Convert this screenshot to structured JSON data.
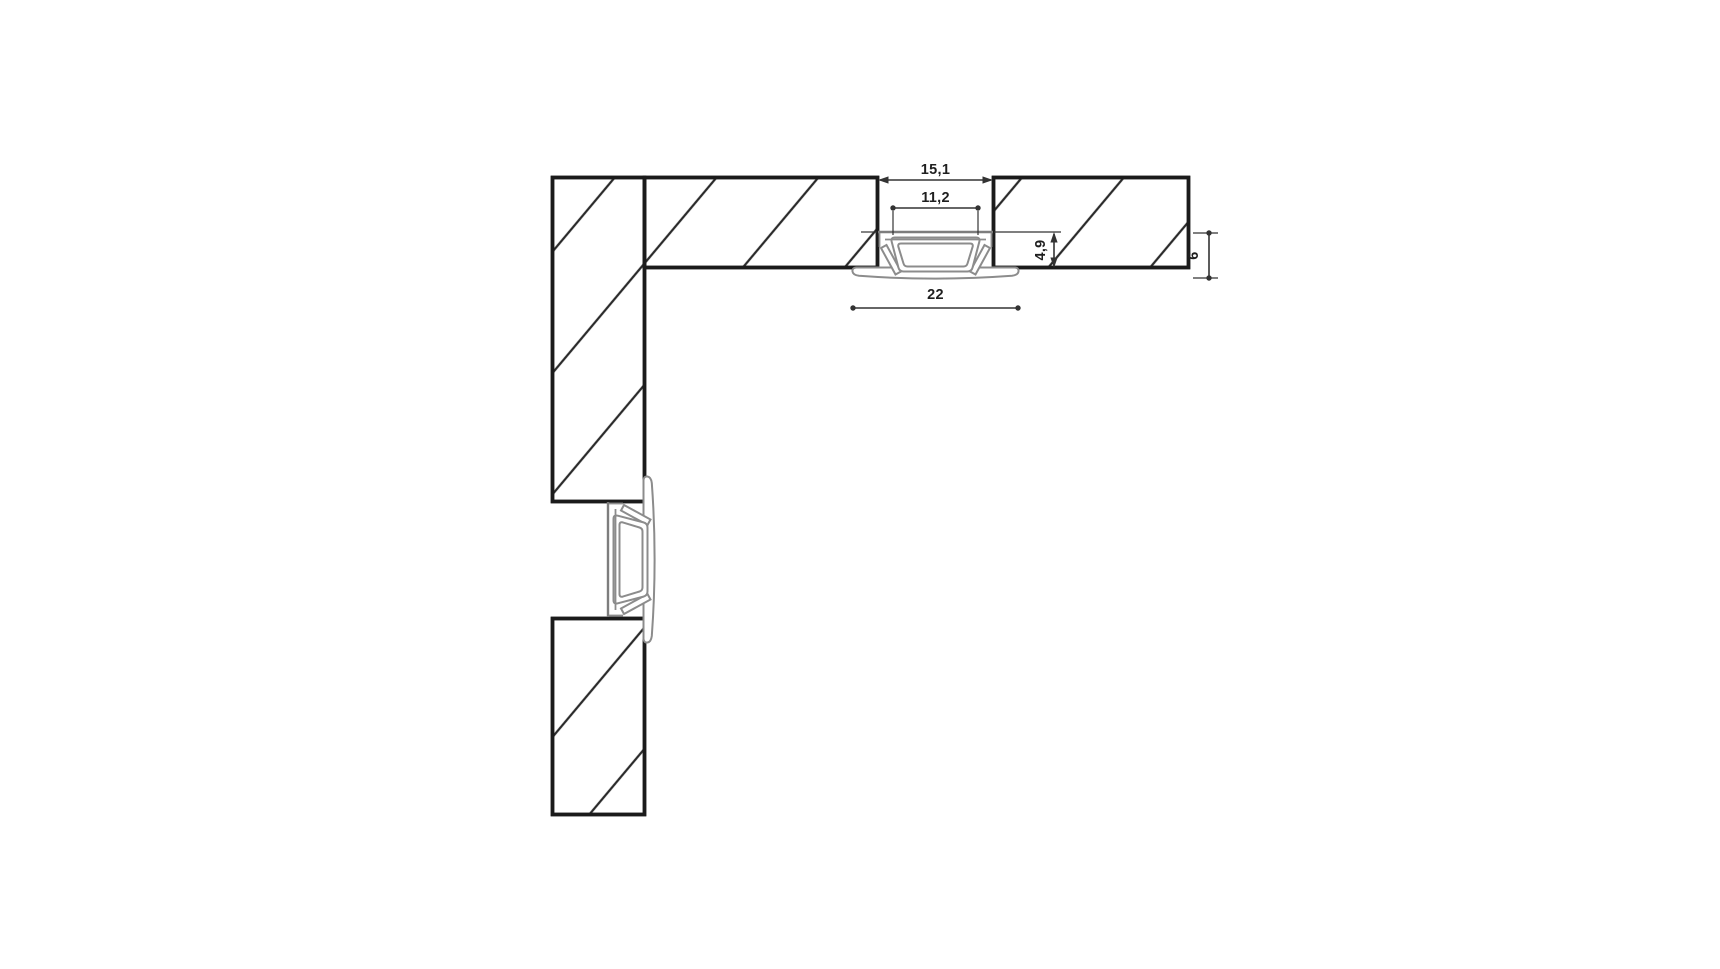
{
  "drawing": {
    "type": "technical-cross-section",
    "subject": "Recessed LED aluminium profile mounted in routed panel grooves, corner detail with two section views",
    "units": "mm",
    "dimensions": {
      "groove_width": "15,1",
      "inner_width": "11,2",
      "recess_depth": "4,9",
      "flange_width": "22",
      "profile_height": "6"
    },
    "colors": {
      "background": "#ffffff",
      "panel_line": "#1b1b1b",
      "hatch_line": "#2a2a2a",
      "profile_line": "#8c8c8c",
      "dimension_line": "#333333",
      "text": "#1f1f1f"
    }
  }
}
